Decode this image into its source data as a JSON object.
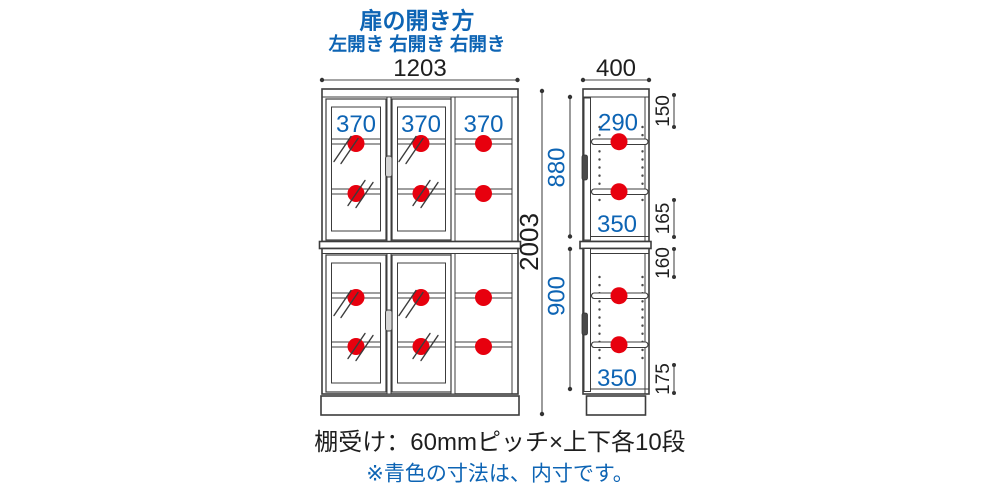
{
  "colors": {
    "accent_blue": "#0d64b4",
    "marker_red": "#e7000e",
    "line_gray": "#3c3c3c"
  },
  "header": {
    "title": "扉の開き方",
    "directions": "左開き 右開き 右開き"
  },
  "front_view": {
    "width": "1203",
    "total_height": "2003",
    "upper_height": "880",
    "lower_height": "900",
    "inner_widths": [
      "370",
      "370",
      "370"
    ]
  },
  "side_view": {
    "depth": "400",
    "upper_top_inner": "290",
    "upper_bottom_inner": "350",
    "lower_bottom_inner": "350",
    "right_offsets": [
      "150",
      "165",
      "160",
      "175"
    ]
  },
  "footer": {
    "shelf_note": "棚受け：60mmピッチ×上下各10段",
    "inner_note": "※青色の寸法は、内寸です。"
  }
}
